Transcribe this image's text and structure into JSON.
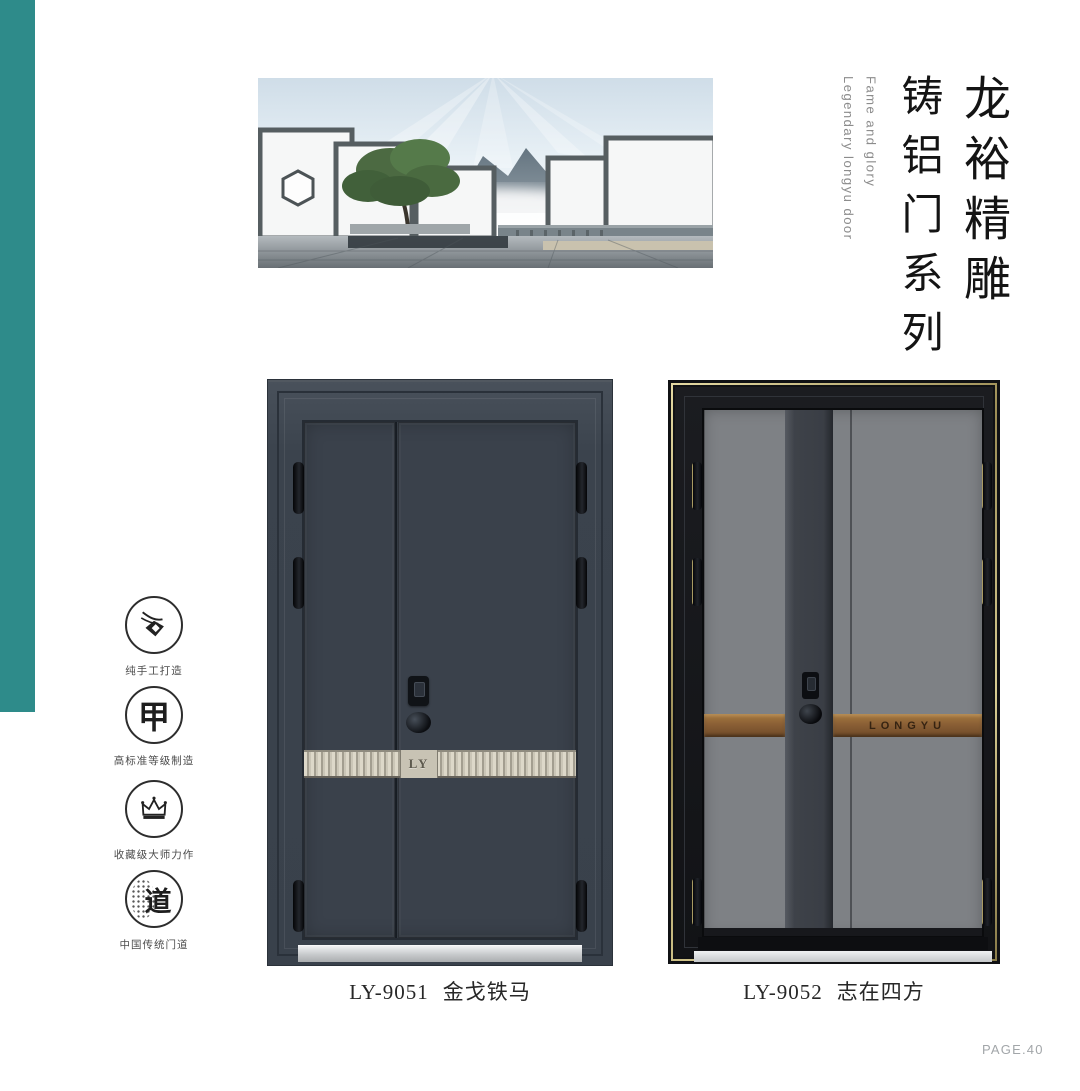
{
  "header": {
    "title_primary": "龙裕精雕",
    "title_secondary": "铸铝门系列",
    "subtitle_en_1": "Fame and glory",
    "subtitle_en_2": "Legendary longyu door"
  },
  "features": [
    {
      "icon": "hand-craft-icon",
      "label": "纯手工打造"
    },
    {
      "icon": "jia-grade-icon",
      "glyph": "甲",
      "label": "高标准等级制造"
    },
    {
      "icon": "crown-icon",
      "label": "收藏级大师力作"
    },
    {
      "icon": "dao-icon",
      "glyph": "道",
      "label": "中国传统门道"
    }
  ],
  "products": [
    {
      "model": "LY-9051",
      "name": "金戈铁马",
      "band_logo": "LY"
    },
    {
      "model": "LY-9052",
      "name": "志在四方",
      "band_logo": "LONGYU"
    }
  ],
  "footer": {
    "page_label": "PAGE.40"
  },
  "colors": {
    "accent_teal": "#2e8b8a",
    "door1_body": "#3a414b",
    "door2_leaf": "#7e8185",
    "copper_band": "#8a5f35",
    "champagne_band": "#cbc6b7"
  }
}
